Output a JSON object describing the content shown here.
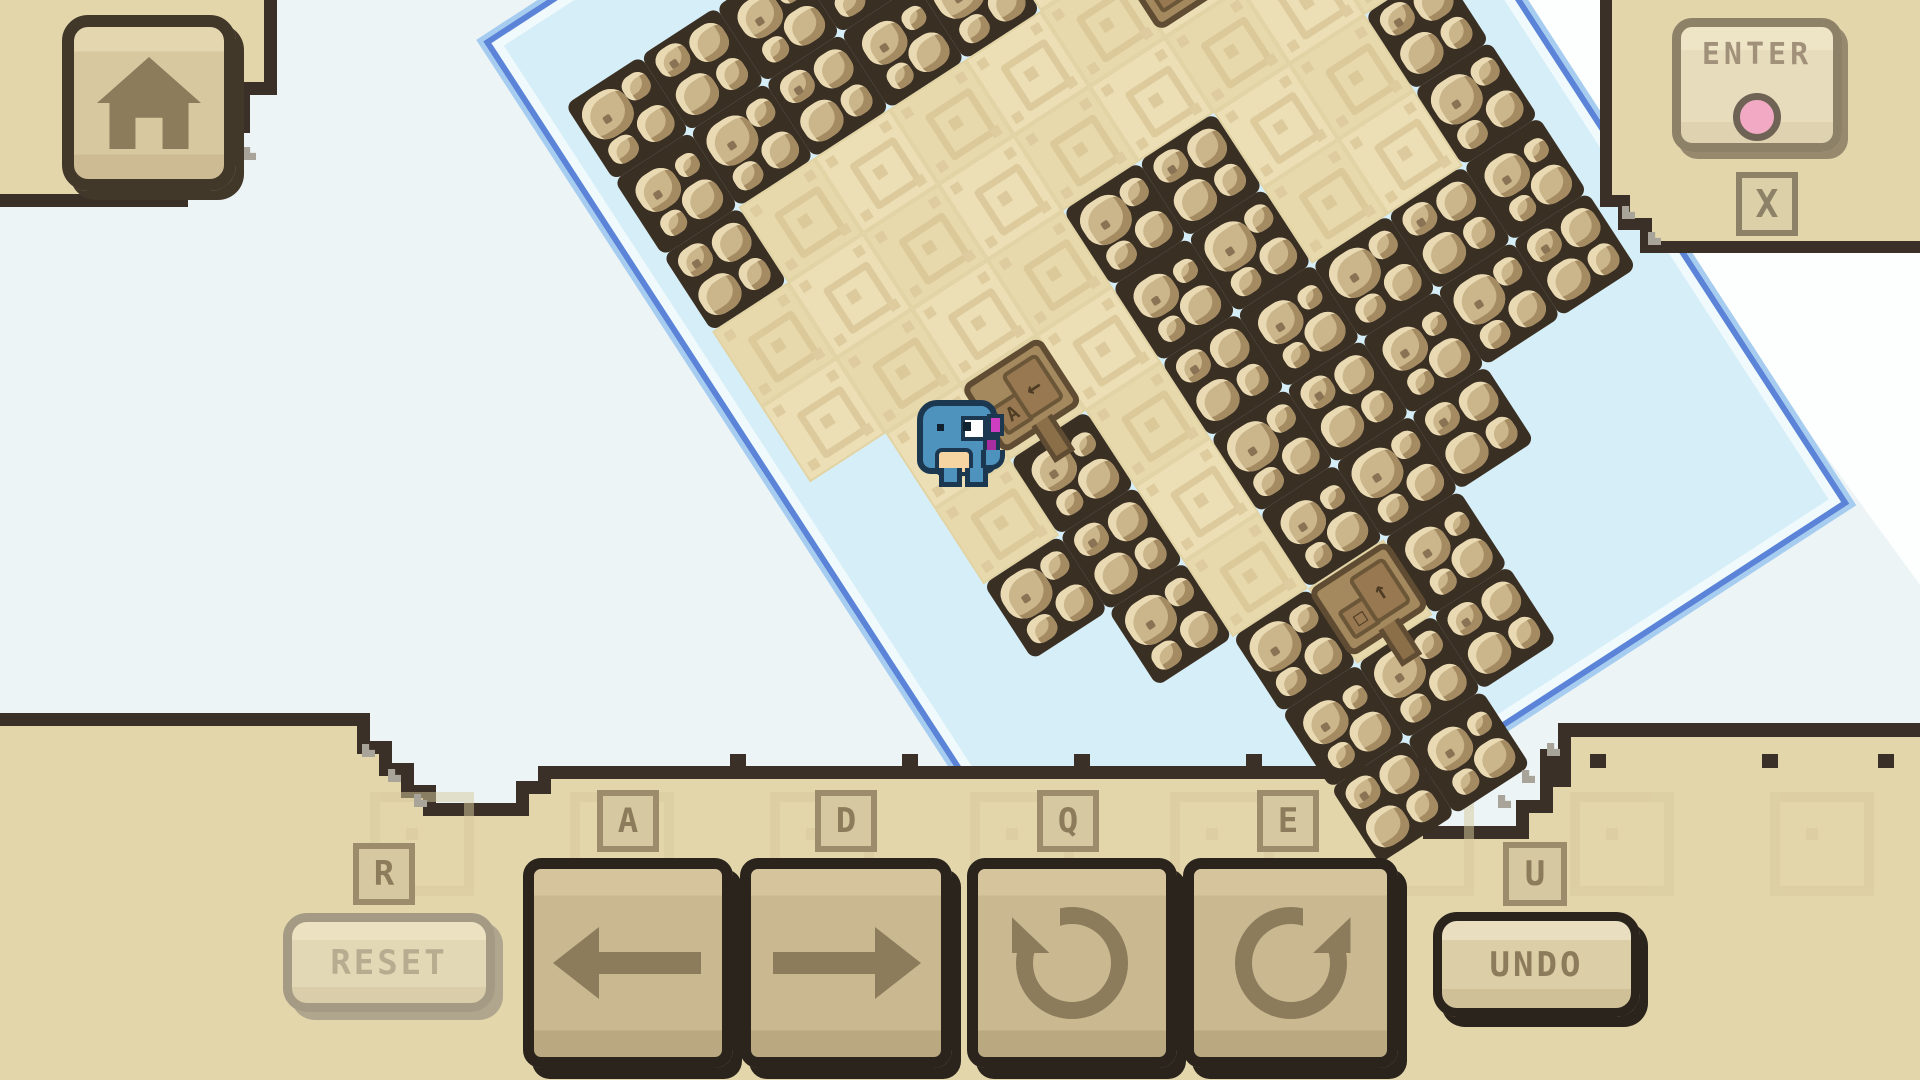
{
  "hud": {
    "home_button": {
      "icon": "home-icon"
    },
    "enter_button": {
      "label": "ENTER",
      "key_hint": "X",
      "dot_color": "#f2a9c4"
    },
    "controls": [
      {
        "key": "R",
        "label": "RESET",
        "type": "text-button",
        "enabled": false
      },
      {
        "key": "A",
        "icon": "arrow-left-icon",
        "enabled": true
      },
      {
        "key": "D",
        "icon": "arrow-right-icon",
        "enabled": true
      },
      {
        "key": "Q",
        "icon": "rotate-ccw-icon",
        "enabled": true
      },
      {
        "key": "E",
        "icon": "rotate-cw-icon",
        "enabled": true
      },
      {
        "key": "U",
        "label": "UNDO",
        "type": "text-button",
        "enabled": true
      }
    ]
  },
  "map": {
    "rotation_deg": -33,
    "tile_size": 90,
    "origin": {
      "x": 565,
      "y": 105
    },
    "legend": {
      "R": "rock",
      "P": "path",
      ".": "water"
    },
    "rows": [
      "RRRRRRRRR",
      "RRRRRPPPR",
      "RPPPPPPPP",
      "PPPPPPPPP",
      "PPPPRRPPR",
      ".PPPRRPPR",
      ".PRPRRRRR",
      ".RRPRRRRR",
      "..RPRRR..",
      "...RPR...",
      "...RRR...",
      "...RR...."
    ],
    "signs": [
      {
        "col": 6,
        "row": 2,
        "panels": [
          "↻",
          "E"
        ],
        "post": false,
        "name": "sign-rotate-hint"
      },
      {
        "col": 2,
        "row": 5,
        "panels": [
          "A",
          "←"
        ],
        "post": true,
        "name": "sign-move-left-hint"
      },
      {
        "col": 4,
        "row": 9,
        "panels": [
          "□",
          "↑"
        ],
        "post": true,
        "name": "sign-goal-hint"
      }
    ],
    "player": {
      "name": "blue-dino",
      "x": 915,
      "y": 398
    }
  },
  "colors": {
    "deep_water": "#ecf4f6",
    "far_water": "#fdfefe",
    "shallow_water": "#d6eef7",
    "shore_blue": "#5b84d8",
    "panel_tan": "#e3d6ab",
    "panel_border": "#3a3027",
    "rock_grout": "#3a2f23",
    "boulder": "#cbb58a",
    "path_sand": "#ecdfb5",
    "button_face": "#c9b890",
    "button_border": "#2a241c",
    "glyph_brown": "#8d7c5b",
    "enter_pink": "#f2a9c4",
    "dino_blue": "#4e93be",
    "dino_outline": "#1c3850",
    "dino_accent": "#cd3fc0"
  }
}
